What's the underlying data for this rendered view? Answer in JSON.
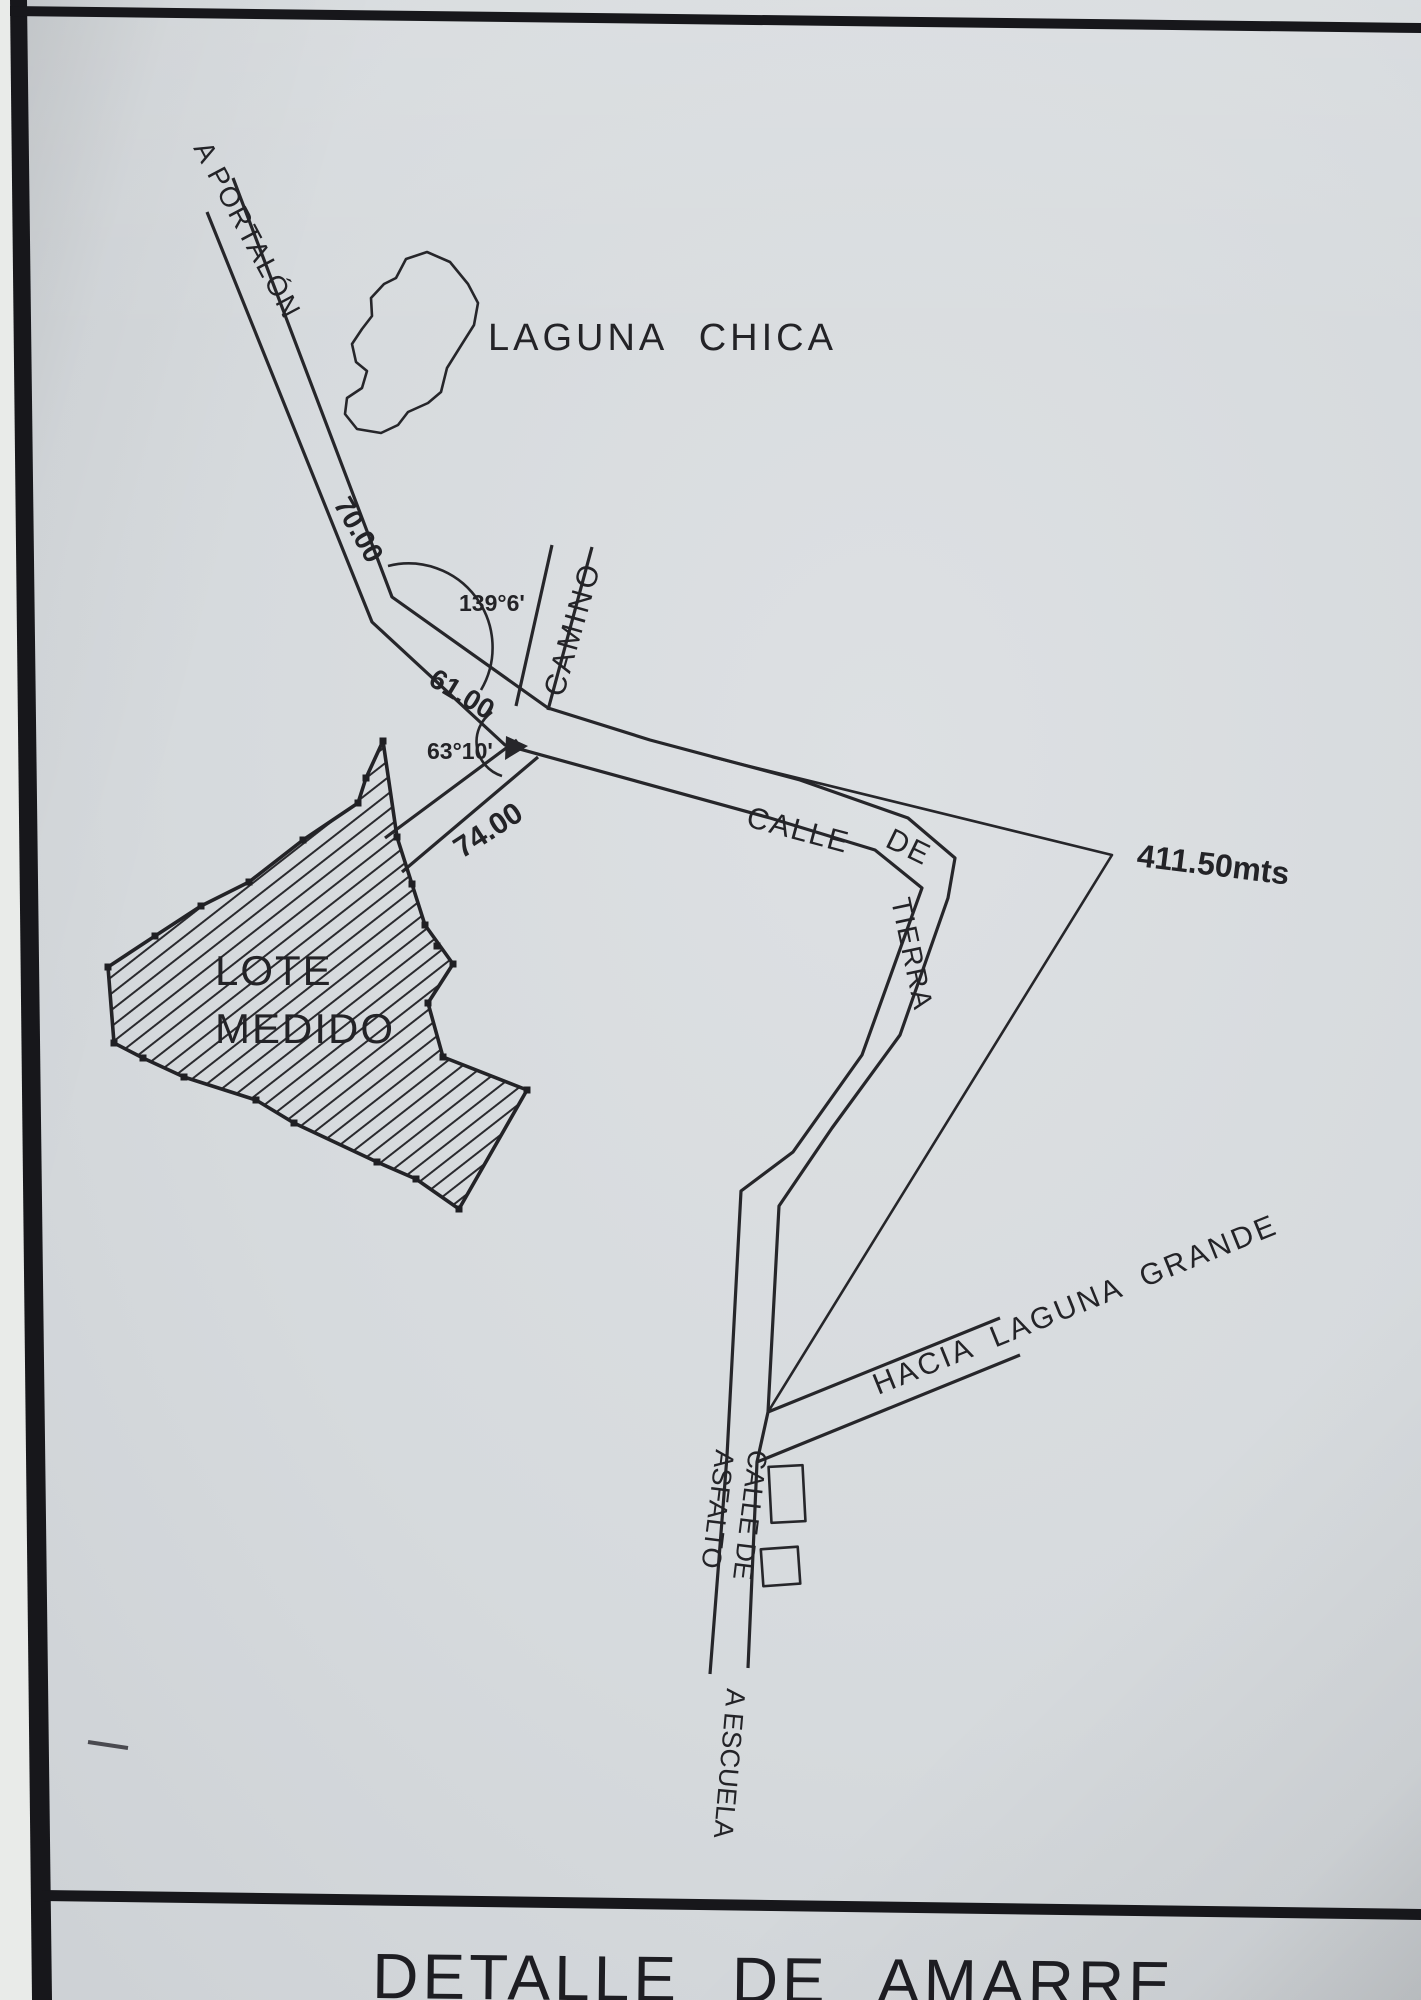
{
  "photo": {
    "paper_color": "#d6dadd",
    "ink_color": "#26262a",
    "frame_color": "#17171b"
  },
  "map": {
    "features": {
      "laguna_chica": "LAGUNA CHICA",
      "lote_medido_line1": "LOTE",
      "lote_medido_line2": "MEDIDO"
    },
    "roads": {
      "a_portalon": "A PORTALÓN",
      "camino": "CAMINO",
      "calle": "CALLE",
      "de": "DE",
      "tierra": "TIERRA",
      "hacia_laguna_grande": "HACIA LAGUNA GRANDE",
      "calle_de": "CALLE DE",
      "asfalto": "ASFALTO",
      "a_escuela": "A ESCUELA"
    },
    "measurements": {
      "seg_portalon": "70.00",
      "seg_middle": "61.00",
      "seg_lote": "74.00",
      "angle_upper": "139°6'",
      "angle_lower": "63°10'",
      "tie_distance": "411.50mts"
    },
    "title": "DETALLE DE AMARRE"
  }
}
